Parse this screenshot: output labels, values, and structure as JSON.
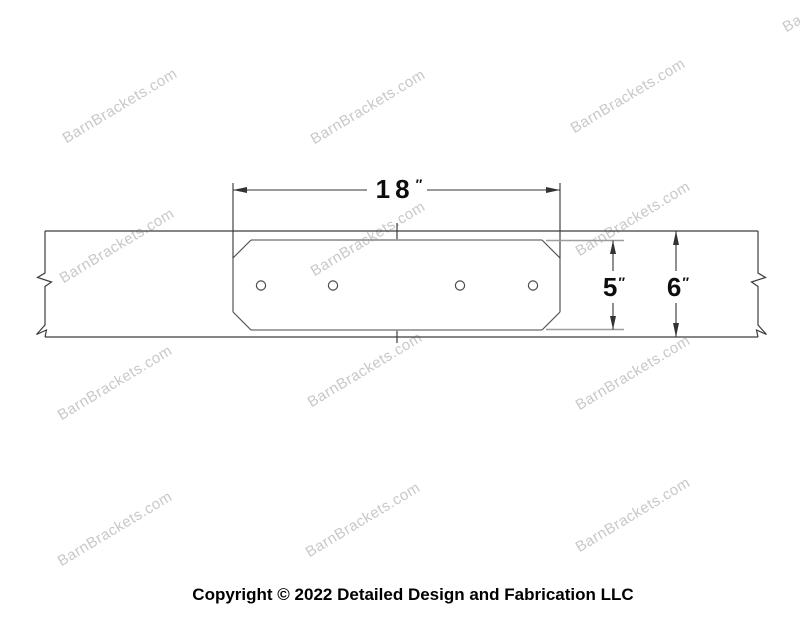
{
  "watermark": {
    "text": "BarnBrackets.com",
    "color": "#c8c8c8"
  },
  "diagram": {
    "type": "bracket-face-technical-drawing",
    "bolt_holes": 4,
    "dimensions": {
      "plate_width": {
        "value": "18",
        "unit": "″"
      },
      "plate_height": {
        "value": "5",
        "unit": "″"
      },
      "beam_height": {
        "value": "6",
        "unit": "″"
      }
    },
    "colors": {
      "beam_line": "#3c3c3c",
      "plate_edge_gray": "#969696",
      "extension_gray": "#9c9c9c",
      "dimension_line": "#333333"
    }
  },
  "footer": {
    "copyright": "Copyright © 2022 Detailed Design and Fabrication LLC"
  }
}
